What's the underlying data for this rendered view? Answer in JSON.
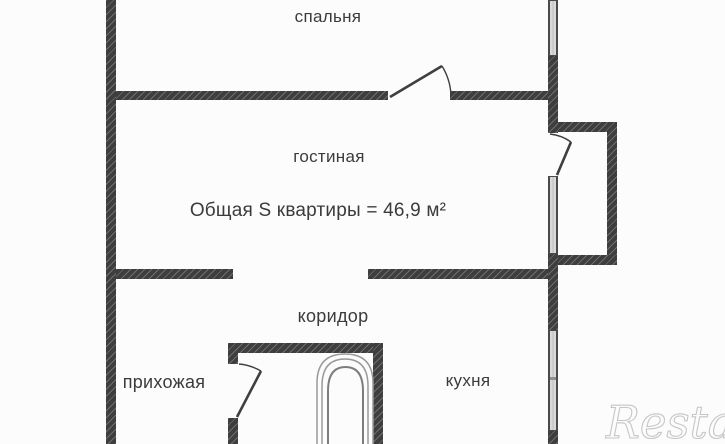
{
  "plan": {
    "type": "apartment-floor-plan",
    "rooms": {
      "bedroom": "спальня",
      "living": "гостиная",
      "corridor": "коридор",
      "hallway": "прихожая",
      "kitchen": "кухня"
    },
    "area_note": "Общая S квартиры = 46,9  м²",
    "watermark": "Restate"
  },
  "colors": {
    "background": "#fcfcfc",
    "wall": "#3e3e3e",
    "wall_hatch": "#6a6a6a",
    "text": "#3b3b3b",
    "window_fill": "#d9d9d9",
    "window_edge": "#4a4a4a",
    "door_line": "#3f3f3f",
    "fixture_line": "#8f8f8f",
    "watermark": "#c6c6c6"
  }
}
